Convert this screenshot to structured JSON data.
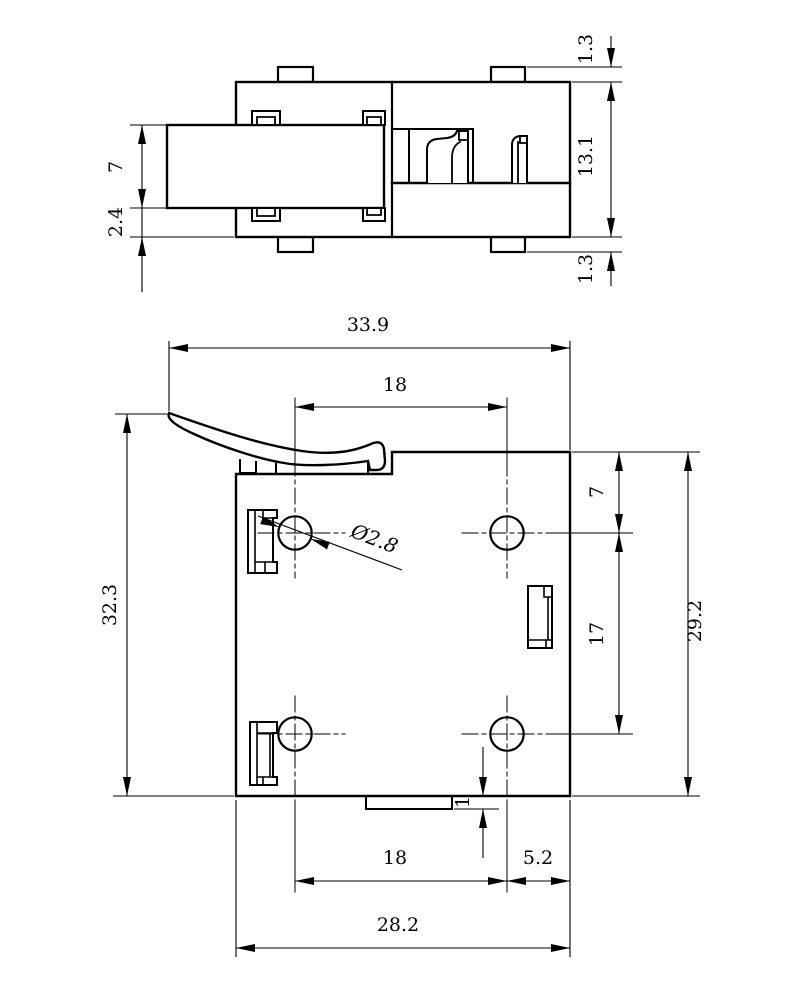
{
  "drawing": {
    "type": "technical-dimension-drawing",
    "background": "#ffffff",
    "line_color": "#000000",
    "top_view": {
      "name": "side-view",
      "dims": {
        "lever_height": "7",
        "base_offset": "2.4",
        "tab_top": "1.3",
        "body_height": "13.1",
        "tab_bottom": "1.3"
      }
    },
    "bottom_view": {
      "name": "plan-view",
      "dims": {
        "overall_width": "33.9",
        "hole_spacing_top": "18",
        "overall_height": "32.3",
        "hole_diameter": "Ø2.8",
        "hole_top_offset": "7",
        "hole_row_spacing": "17",
        "body_height": "29.2",
        "tab_depth": "1",
        "hole_spacing_bottom": "18",
        "edge_offset": "5.2",
        "body_width": "28.2"
      }
    }
  }
}
